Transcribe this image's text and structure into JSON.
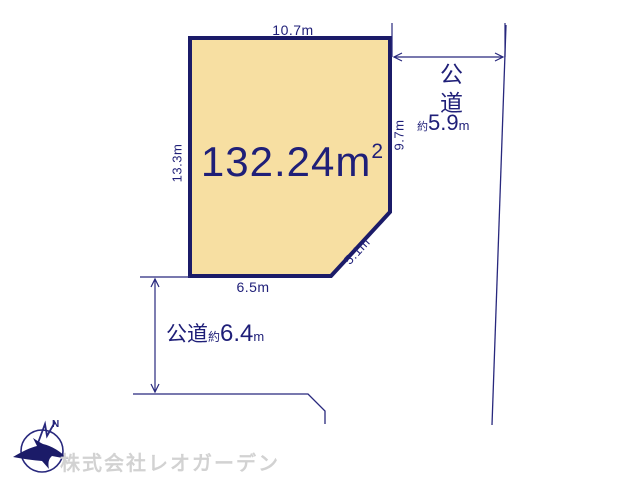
{
  "plot": {
    "area_value": "132.24",
    "area_unit": "m",
    "area_sup": "2",
    "dim_top": "10.7m",
    "dim_left": "13.3m",
    "dim_right": "9.7m",
    "dim_diagonal": "5.1m",
    "dim_bottom": "6.5m"
  },
  "roads": {
    "right": {
      "name": "公道",
      "approx": "約",
      "value": "5.9",
      "unit": "m"
    },
    "bottom": {
      "name": "公道",
      "approx": "約",
      "value": "6.4",
      "unit": "m"
    }
  },
  "compass": {
    "north_label": "N"
  },
  "footer": {
    "company": "株式会社レオガーデン"
  },
  "colors": {
    "plot_fill": "#F7DFA2",
    "plot_border": "#1B1B68",
    "line_navy": "#28287D",
    "text_navy": "#1F1F78",
    "watermark_gray": "#D2D2D2"
  }
}
